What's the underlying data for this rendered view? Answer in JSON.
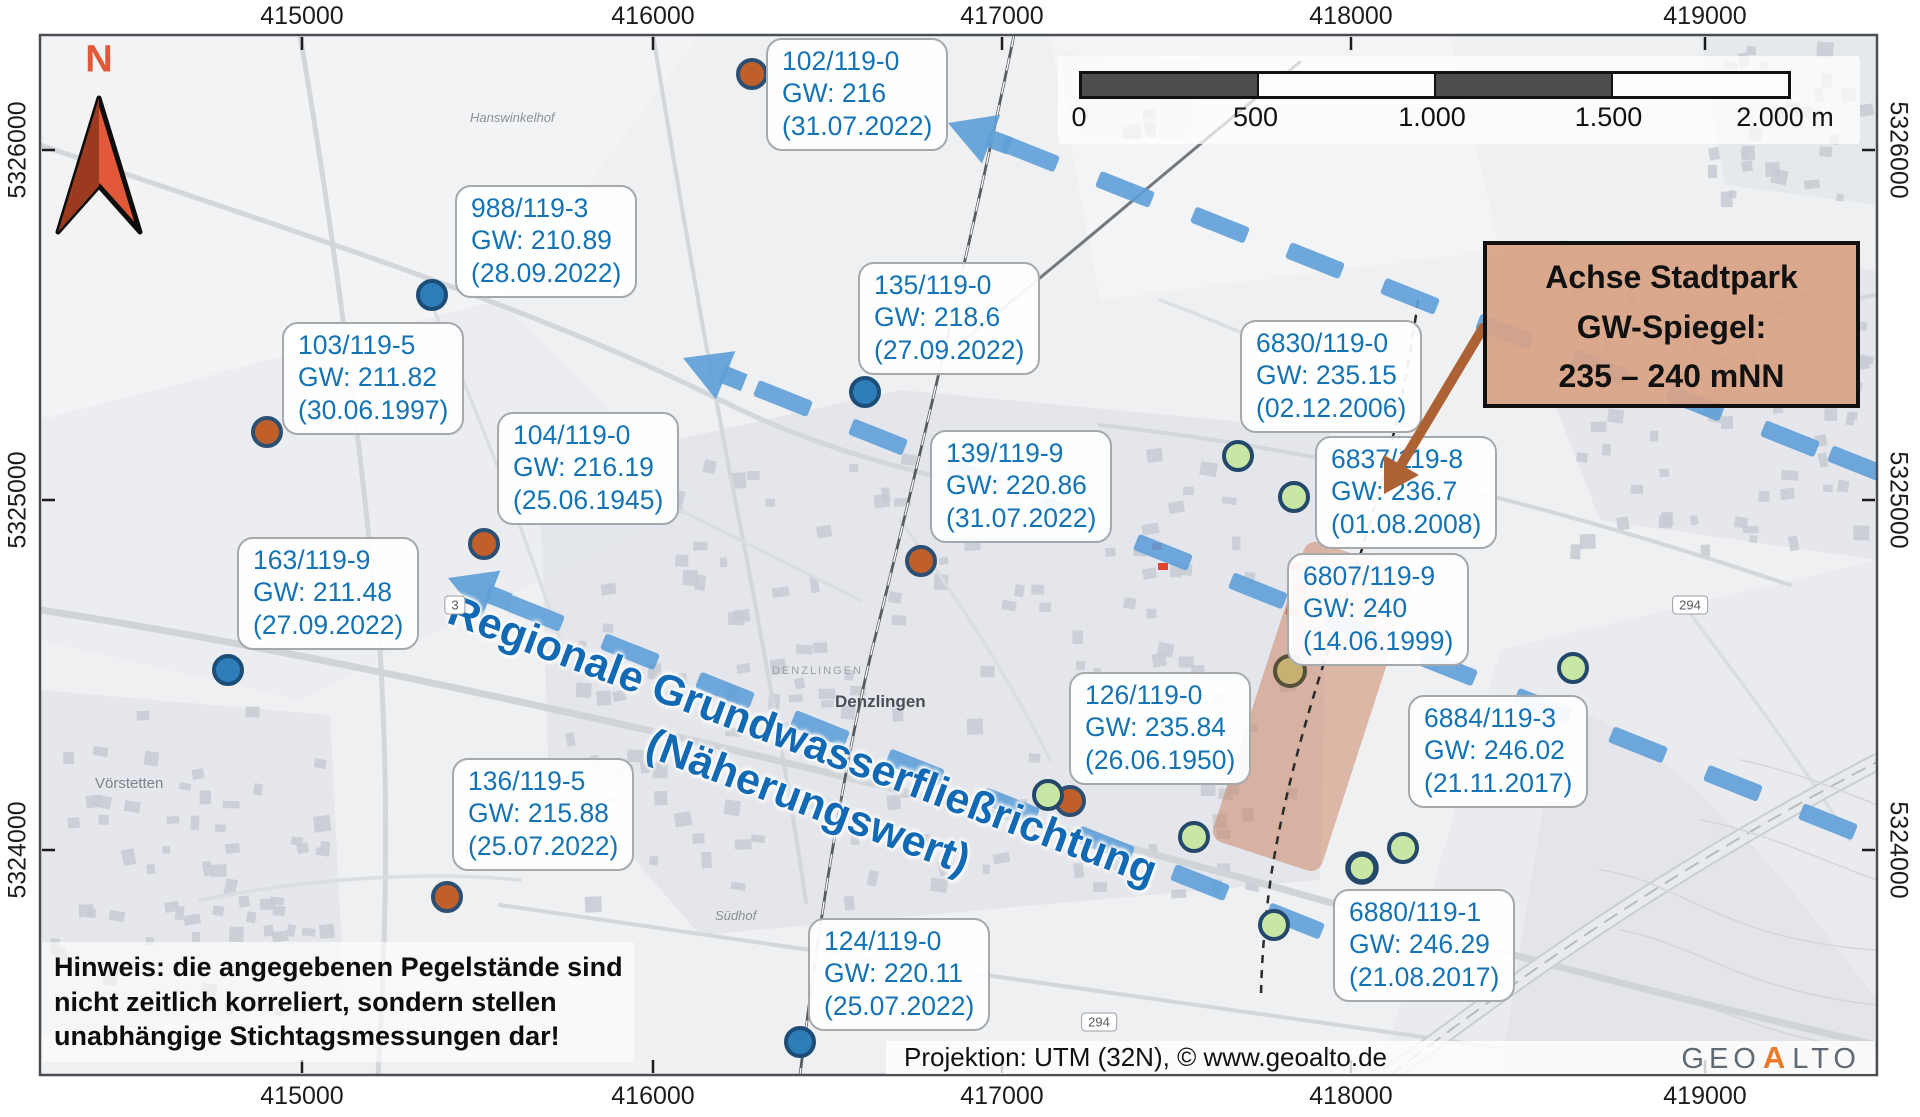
{
  "colors": {
    "label_blue": "#1473b5",
    "flow_blue": "#5e9fd8",
    "flow_text_blue": "#1269b4",
    "strip_orange": "#cb7f5d",
    "north_red": "#e2593a",
    "north_red_dark": "#9c3a1f",
    "logo_orange": "#e87a2a",
    "dot_blue": "#2e7cb8",
    "dot_orange": "#c05f2a",
    "dot_green": "#c9e7a4",
    "dot_tan": "#c6b172"
  },
  "north_label": "N",
  "axes": {
    "x": [
      {
        "label": "415000",
        "px": 302
      },
      {
        "label": "416000",
        "px": 653
      },
      {
        "label": "417000",
        "px": 1002
      },
      {
        "label": "418000",
        "px": 1351
      },
      {
        "label": "419000",
        "px": 1705
      }
    ],
    "y": [
      {
        "label": "5326000",
        "py": 150
      },
      {
        "label": "5325000",
        "py": 500
      },
      {
        "label": "5324000",
        "py": 850
      }
    ]
  },
  "scalebar": {
    "labels": [
      "0",
      "500",
      "1.000",
      "1.500",
      "2.000 m"
    ]
  },
  "stations": [
    {
      "name": "102/119-0",
      "gw": "GW: 216",
      "date": "(31.07.2022)",
      "color": "orange",
      "box": {
        "x": 766,
        "y": 38
      },
      "dot": {
        "x": 752,
        "y": 74
      }
    },
    {
      "name": "988/119-3",
      "gw": "GW: 210.89",
      "date": "(28.09.2022)",
      "color": "blue",
      "box": {
        "x": 455,
        "y": 185
      },
      "dot": {
        "x": 432,
        "y": 295
      }
    },
    {
      "name": "103/119-5",
      "gw": "GW: 211.82",
      "date": "(30.06.1997)",
      "color": "orange",
      "box": {
        "x": 282,
        "y": 322
      },
      "dot": {
        "x": 267,
        "y": 432
      }
    },
    {
      "name": "104/119-0",
      "gw": "GW: 216.19",
      "date": "(25.06.1945)",
      "color": "orange",
      "box": {
        "x": 497,
        "y": 412
      },
      "dot": {
        "x": 484,
        "y": 544
      }
    },
    {
      "name": "163/119-9",
      "gw": "GW: 211.48",
      "date": "(27.09.2022)",
      "color": "blue",
      "box": {
        "x": 237,
        "y": 537
      },
      "dot": {
        "x": 228,
        "y": 670
      }
    },
    {
      "name": "136/119-5",
      "gw": "GW: 215.88",
      "date": "(25.07.2022)",
      "color": "orange",
      "box": {
        "x": 452,
        "y": 758
      },
      "dot": {
        "x": 447,
        "y": 897
      }
    },
    {
      "name": "135/119-0",
      "gw": "GW: 218.6",
      "date": "(27.09.2022)",
      "color": "blue",
      "box": {
        "x": 858,
        "y": 262
      },
      "dot": {
        "x": 865,
        "y": 392
      }
    },
    {
      "name": "139/119-9",
      "gw": "GW: 220.86",
      "date": "(31.07.2022)",
      "color": "orange",
      "box": {
        "x": 930,
        "y": 430
      },
      "dot": {
        "x": 921,
        "y": 561
      }
    },
    {
      "name": "124/119-0",
      "gw": "GW: 220.11",
      "date": "(25.07.2022)",
      "color": "blue",
      "box": {
        "x": 808,
        "y": 918
      },
      "dot": {
        "x": 800,
        "y": 1042
      }
    },
    {
      "name": "126/119-0",
      "gw": "GW: 235.84",
      "date": "(26.06.1950)",
      "color": "green",
      "box": {
        "x": 1069,
        "y": 672
      },
      "dot": {
        "x": 1048,
        "y": 795
      }
    },
    {
      "name": "6830/119-0",
      "gw": "GW: 235.15",
      "date": "(02.12.2006)",
      "color": "green",
      "box": {
        "x": 1240,
        "y": 320
      },
      "dot": {
        "x": 1238,
        "y": 456
      }
    },
    {
      "name": "6837/119-8",
      "gw": "GW: 236.7",
      "date": "(01.08.2008)",
      "color": "green",
      "box": {
        "x": 1315,
        "y": 436
      },
      "dot": {
        "x": 1294,
        "y": 497
      }
    },
    {
      "name": "6807/119-9",
      "gw": "GW: 240",
      "date": "(14.06.1999)",
      "color": "tan",
      "box": {
        "x": 1287,
        "y": 553
      },
      "dot": {
        "x": 1290,
        "y": 671
      }
    },
    {
      "name": "6884/119-3",
      "gw": "GW: 246.02",
      "date": "(21.11.2017)",
      "color": "green",
      "box": {
        "x": 1408,
        "y": 695
      },
      "dot": {
        "x": 1403,
        "y": 848
      }
    },
    {
      "name": "6880/119-1",
      "gw": "GW: 246.29",
      "date": "(21.08.2017)",
      "color": "green",
      "box": {
        "x": 1333,
        "y": 889
      },
      "dot": {
        "x": 1274,
        "y": 925
      }
    }
  ],
  "extra_dots": [
    {
      "color": "orange",
      "x": 1070,
      "y": 801
    },
    {
      "color": "green",
      "x": 1194,
      "y": 837
    },
    {
      "color": "green",
      "x": 1362,
      "y": 868,
      "thick": true
    },
    {
      "color": "green",
      "x": 1573,
      "y": 668
    }
  ],
  "flow_label": {
    "line1": "Regionale Grundwasserfließrichtung",
    "line2": "(Näherungswert)"
  },
  "achse": {
    "line1": "Achse Stadtpark",
    "line2": "GW-Spiegel:",
    "line3": "235 – 240 mNN"
  },
  "note": {
    "line1": "Hinweis: die angegebenen Pegelstände sind",
    "line2": "nicht zeitlich korreliert, sondern stellen",
    "line3": "unabhängige Stichtagsmessungen dar!"
  },
  "attribution": {
    "text": "Projektion: UTM (32N), © www.geoalto.de",
    "logo": {
      "geo": "GEO",
      "a": "A",
      "lto": "LTO"
    }
  },
  "places": [
    {
      "name": "Hanswinkelhof",
      "x": 470,
      "y": 110,
      "style": "farm"
    },
    {
      "name": "Vörstetten",
      "x": 95,
      "y": 775,
      "style": "village"
    },
    {
      "name": "Südhof",
      "x": 715,
      "y": 908,
      "style": "farm"
    },
    {
      "name": "DENZLINGEN",
      "x": 772,
      "y": 665,
      "style": "muni"
    },
    {
      "name": "Denzlingen",
      "x": 835,
      "y": 692,
      "style": "town"
    }
  ],
  "road_badges": [
    {
      "label": "3",
      "x": 455,
      "y": 605
    },
    {
      "label": "294",
      "x": 1690,
      "y": 605
    },
    {
      "label": "294",
      "x": 1099,
      "y": 1022
    }
  ]
}
